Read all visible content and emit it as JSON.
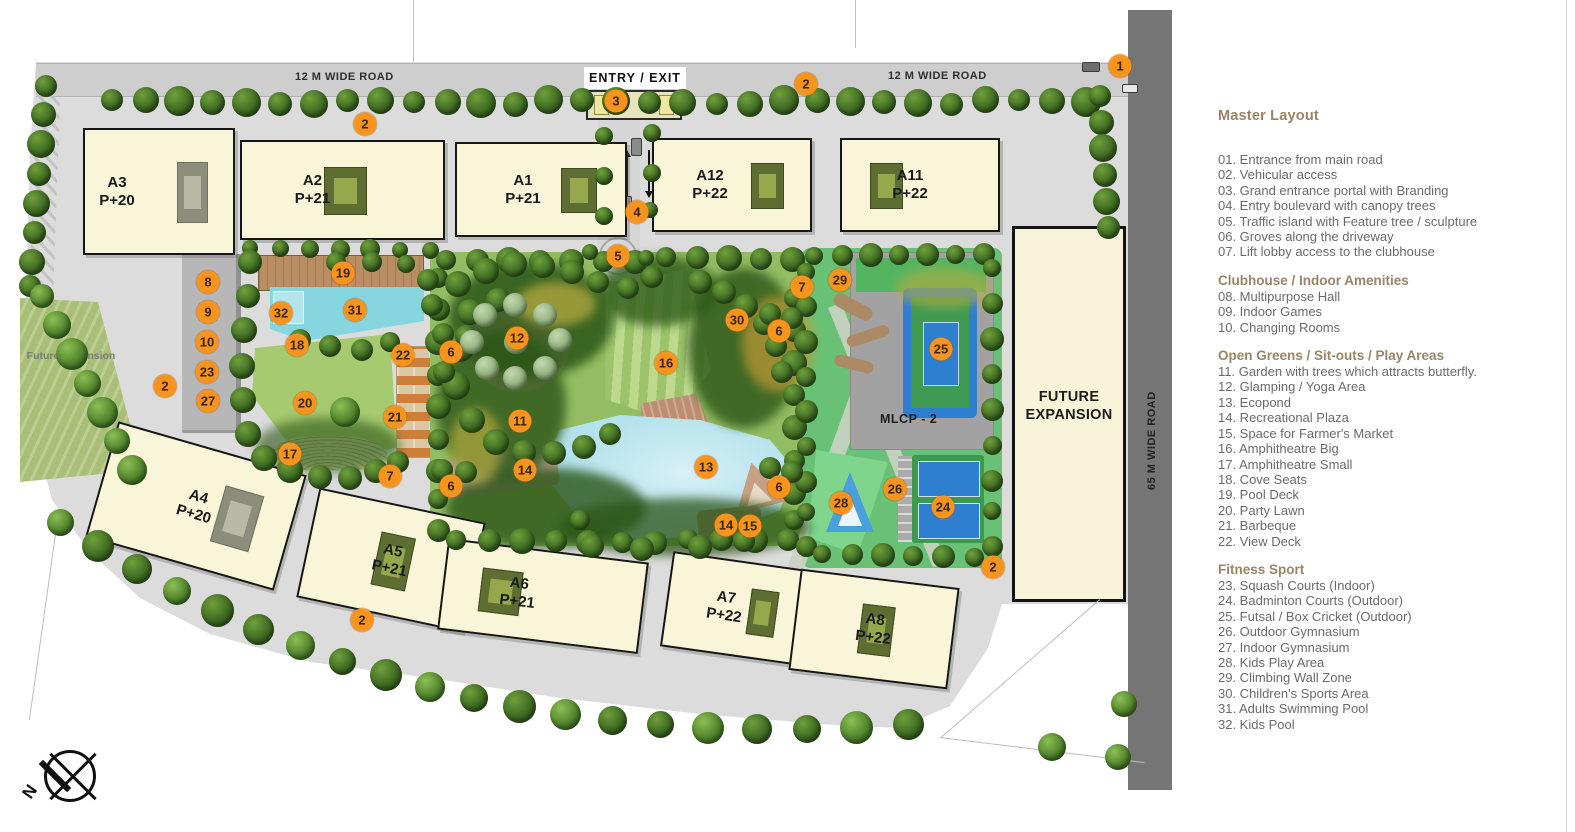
{
  "legend": {
    "title": "Master Layout",
    "sections": [
      {
        "heading": null,
        "items": [
          {
            "num": "01",
            "label": "Entrance from main road"
          },
          {
            "num": "02",
            "label": "Vehicular access"
          },
          {
            "num": "03",
            "label": "Grand entrance portal with Branding"
          },
          {
            "num": "04",
            "label": "Entry boulevard with canopy trees"
          },
          {
            "num": "05",
            "label": "Traffic island with Feature tree / sculpture"
          },
          {
            "num": "06",
            "label": "Groves along the driveway"
          },
          {
            "num": "07",
            "label": "Lift lobby access to the clubhouse"
          }
        ]
      },
      {
        "heading": "Clubhouse / Indoor Amenities",
        "items": [
          {
            "num": "08",
            "label": "Multipurpose Hall"
          },
          {
            "num": "09",
            "label": "Indoor Games"
          },
          {
            "num": "10",
            "label": "Changing Rooms"
          }
        ]
      },
      {
        "heading": "Open Greens / Sit-outs / Play Areas",
        "items": [
          {
            "num": "11",
            "label": "Garden with trees which attracts butterfly."
          },
          {
            "num": "12",
            "label": "Glamping / Yoga Area"
          },
          {
            "num": "13",
            "label": "Ecopond"
          },
          {
            "num": "14",
            "label": "Recreational Plaza"
          },
          {
            "num": "15",
            "label": "Space for Farmer's Market"
          },
          {
            "num": "16",
            "label": "Amphitheatre Big"
          },
          {
            "num": "17",
            "label": "Amphitheatre Small"
          },
          {
            "num": "18",
            "label": "Cove Seats"
          },
          {
            "num": "19",
            "label": "Pool Deck"
          },
          {
            "num": "20",
            "label": "Party Lawn"
          },
          {
            "num": "21",
            "label": "Barbeque"
          },
          {
            "num": "22",
            "label": "View Deck"
          }
        ]
      },
      {
        "heading": "Fitness Sport",
        "items": [
          {
            "num": "23",
            "label": "Squash Courts (Indoor)"
          },
          {
            "num": "24",
            "label": "Badminton Courts (Outdoor)"
          },
          {
            "num": "25",
            "label": "Futsal / Box Cricket (Outdoor)"
          },
          {
            "num": "26",
            "label": "Outdoor Gymnasium"
          },
          {
            "num": "27",
            "label": "Indoor Gymnasium"
          },
          {
            "num": "28",
            "label": "Kids Play Area"
          },
          {
            "num": "29",
            "label": "Climbing Wall Zone"
          },
          {
            "num": "30",
            "label": "Children's Sports Area"
          },
          {
            "num": "31",
            "label": "Adults Swimming Pool"
          },
          {
            "num": "32",
            "label": "Kids Pool"
          }
        ]
      }
    ]
  },
  "plan": {
    "road_top_left": "12 M WIDE ROAD",
    "road_top_right": "12 M WIDE ROAD",
    "road_right": "65 M WIDE ROAD",
    "entry_label": "ENTRY / EXIT",
    "mlcp_label": "MLCP - 2",
    "future_expansion_main": "FUTURE EXPANSION",
    "future_expansion_left": "Future Expansion",
    "north_label": "N",
    "buildings": [
      {
        "name": "A3",
        "floors": "P+20",
        "x": 83,
        "y": 128,
        "w": 152,
        "h": 127,
        "rot": 0,
        "ldx": -42,
        "patch": "grey",
        "pside": "r"
      },
      {
        "name": "A2",
        "floors": "P+21",
        "x": 240,
        "y": 140,
        "w": 205,
        "h": 100,
        "rot": 0,
        "ldx": -30,
        "patch": "olive",
        "pside": "c"
      },
      {
        "name": "A1",
        "floors": "P+21",
        "x": 455,
        "y": 142,
        "w": 172,
        "h": 95,
        "rot": 0,
        "ldx": -18,
        "patch": "olive",
        "pside": "r"
      },
      {
        "name": "A12",
        "floors": "P+22",
        "x": 652,
        "y": 138,
        "w": 160,
        "h": 94,
        "rot": 0,
        "ldx": -22,
        "patch": "olive",
        "pside": "r"
      },
      {
        "name": "A11",
        "floors": "P+22",
        "x": 840,
        "y": 138,
        "w": 160,
        "h": 94,
        "rot": 0,
        "ldx": -10,
        "patch": "olive",
        "pside": "l"
      },
      {
        "name": "A4",
        "floors": "P+20",
        "x": 98,
        "y": 446,
        "w": 196,
        "h": 120,
        "rot": 16,
        "ldx": 0,
        "patch": "grey",
        "pside": "r"
      },
      {
        "name": "A5",
        "floors": "P+21",
        "x": 306,
        "y": 504,
        "w": 170,
        "h": 112,
        "rot": 12,
        "ldx": 0,
        "patch": "olive",
        "pside": "c"
      },
      {
        "name": "A6",
        "floors": "P+21",
        "x": 442,
        "y": 550,
        "w": 202,
        "h": 92,
        "rot": 7,
        "ldx": -25,
        "patch": "olive",
        "pside": "l"
      },
      {
        "name": "A7",
        "floors": "P+22",
        "x": 666,
        "y": 560,
        "w": 134,
        "h": 96,
        "rot": 8,
        "ldx": -8,
        "patch": "olive",
        "pside": "r"
      },
      {
        "name": "A8",
        "floors": "P+22",
        "x": 794,
        "y": 578,
        "w": 160,
        "h": 102,
        "rot": 7,
        "ldx": 0,
        "patch": "olive",
        "pside": "c"
      }
    ],
    "markers": [
      {
        "n": "1",
        "x": 1120,
        "y": 66
      },
      {
        "n": "2",
        "x": 365,
        "y": 124
      },
      {
        "n": "2",
        "x": 806,
        "y": 84
      },
      {
        "n": "2",
        "x": 165,
        "y": 386
      },
      {
        "n": "2",
        "x": 362,
        "y": 620
      },
      {
        "n": "2",
        "x": 993,
        "y": 567
      },
      {
        "n": "3",
        "x": 616,
        "y": 101
      },
      {
        "n": "4",
        "x": 637,
        "y": 212
      },
      {
        "n": "5",
        "x": 618,
        "y": 256
      },
      {
        "n": "6",
        "x": 451,
        "y": 352
      },
      {
        "n": "6",
        "x": 779,
        "y": 331
      },
      {
        "n": "6",
        "x": 451,
        "y": 486
      },
      {
        "n": "6",
        "x": 779,
        "y": 487
      },
      {
        "n": "7",
        "x": 802,
        "y": 287
      },
      {
        "n": "7",
        "x": 390,
        "y": 476
      },
      {
        "n": "8",
        "x": 208,
        "y": 282
      },
      {
        "n": "9",
        "x": 208,
        "y": 312
      },
      {
        "n": "10",
        "x": 207,
        "y": 342
      },
      {
        "n": "11",
        "x": 520,
        "y": 421
      },
      {
        "n": "12",
        "x": 517,
        "y": 338
      },
      {
        "n": "13",
        "x": 706,
        "y": 467
      },
      {
        "n": "14",
        "x": 525,
        "y": 470
      },
      {
        "n": "14",
        "x": 726,
        "y": 525
      },
      {
        "n": "15",
        "x": 750,
        "y": 526
      },
      {
        "n": "16",
        "x": 666,
        "y": 363
      },
      {
        "n": "17",
        "x": 290,
        "y": 454
      },
      {
        "n": "18",
        "x": 297,
        "y": 345
      },
      {
        "n": "19",
        "x": 343,
        "y": 273
      },
      {
        "n": "20",
        "x": 305,
        "y": 403
      },
      {
        "n": "21",
        "x": 395,
        "y": 417
      },
      {
        "n": "22",
        "x": 403,
        "y": 355
      },
      {
        "n": "23",
        "x": 207,
        "y": 372
      },
      {
        "n": "24",
        "x": 943,
        "y": 507
      },
      {
        "n": "25",
        "x": 941,
        "y": 349
      },
      {
        "n": "26",
        "x": 895,
        "y": 489
      },
      {
        "n": "27",
        "x": 208,
        "y": 401
      },
      {
        "n": "28",
        "x": 841,
        "y": 503
      },
      {
        "n": "29",
        "x": 840,
        "y": 280
      },
      {
        "n": "30",
        "x": 737,
        "y": 320
      },
      {
        "n": "31",
        "x": 355,
        "y": 310
      },
      {
        "n": "32",
        "x": 281,
        "y": 313
      }
    ]
  },
  "colors": {
    "marker_orange": "#f7941e",
    "legend_heading": "#9a8468",
    "legend_text": "#6a6a6a",
    "building_cream": "#f8f5d8",
    "park_green": "#93bd62",
    "sports_green": "#69c175",
    "court_blue": "#2f7fd0",
    "water": "#b3e1ec",
    "road_dark": "#757575",
    "pavement": "#dcdcdc"
  }
}
